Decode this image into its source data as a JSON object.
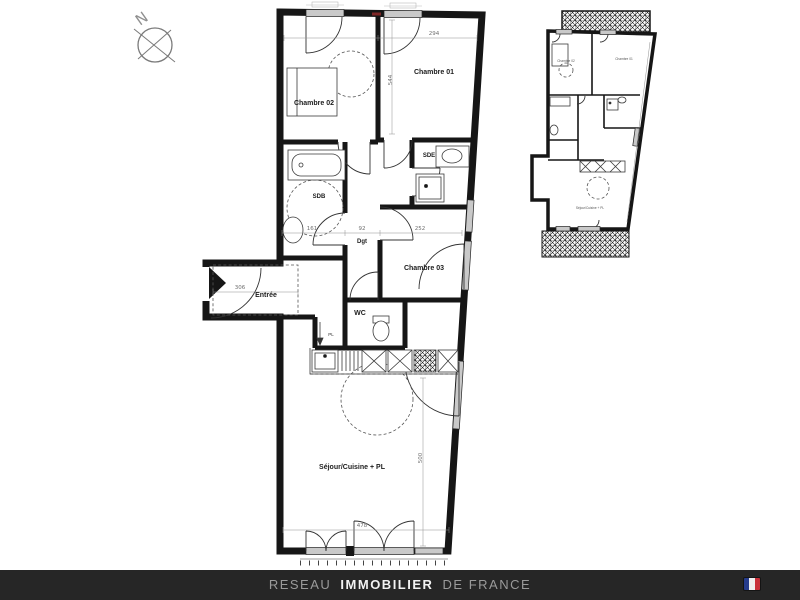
{
  "theme": {
    "footer_bar": "#262626",
    "footer_text_dim": "#9a9a9a",
    "footer_text_bright": "#f2f2f2",
    "flag_blue": "#263c8c",
    "flag_white": "#efefef",
    "flag_red": "#c8303a",
    "plan_ink": "#161616",
    "dim_ink": "#8f8f8f"
  },
  "compass": {
    "north_letter": "N"
  },
  "main_plan": {
    "rooms": {
      "chambre01": "Chambre 01",
      "chambre02": "Chambre 02",
      "chambre03": "Chambre 03",
      "sdb": "SDB",
      "sde": "SDE",
      "dgt": "Dgt",
      "entree": "Entrée",
      "wc": "WC",
      "sejour": "Séjour/Cuisine + PL"
    },
    "closets": {
      "pl": "PL"
    },
    "dimensions": {
      "bedrooms_width": "294",
      "bedroom1_height": "544",
      "sdb_width": "161",
      "dgt_width": "92",
      "chambre03_width": "252",
      "entree_length": "306",
      "sejour_width": "478",
      "sejour_height": "500"
    }
  },
  "mini_plan": {
    "rooms": {
      "chambre01": "Chambre 01",
      "chambre02": "Chambre 02",
      "sejour": "Séjour/Cuisine + PL"
    }
  },
  "footer": {
    "brand": {
      "prefix": "RESEAU",
      "main": "IMMOBILIER",
      "suffix": "DE FRANCE"
    }
  }
}
